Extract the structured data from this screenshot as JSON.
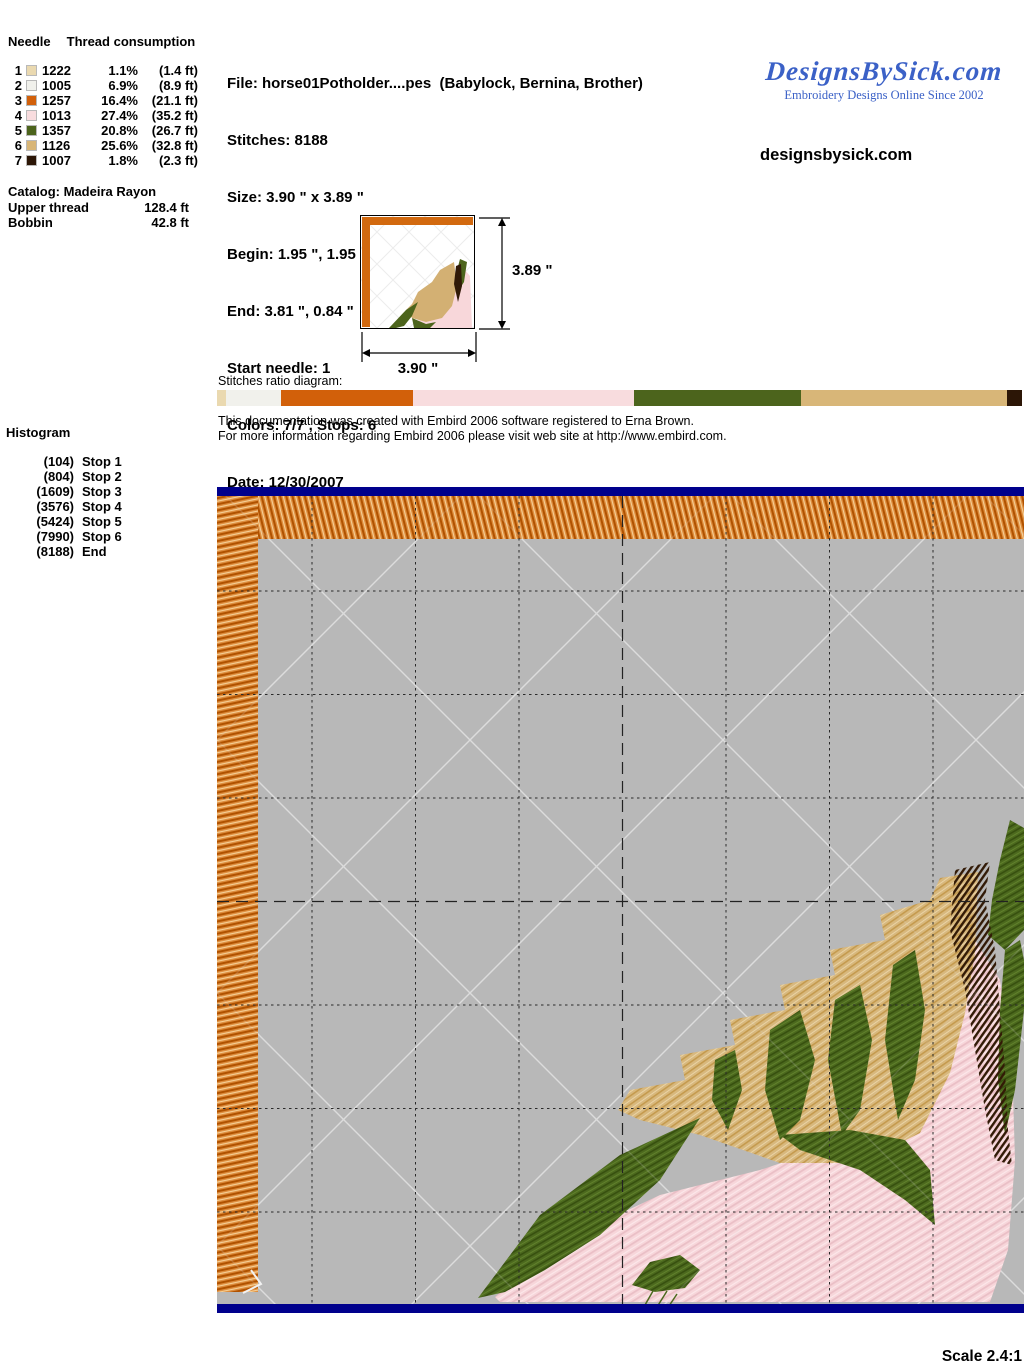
{
  "palette": {
    "hoop_bar_blue": "#00008c",
    "canvas_gray": "#b8b8b8",
    "border_stitch_orange": "#dc8a3a",
    "logo_blue": "#3b61c7",
    "grid_line": "#2a2a2a",
    "quilt_line": "#dedede"
  },
  "needle_table": {
    "header_needle": "Needle",
    "header_consumption": "Thread consumption",
    "rows": [
      {
        "needle": "1",
        "thread": "1222",
        "pct": "1.1%",
        "pct_value": 1.1,
        "length": "(1.4 ft)",
        "color": "#ead9b0"
      },
      {
        "needle": "2",
        "thread": "1005",
        "pct": "6.9%",
        "pct_value": 6.9,
        "length": "(8.9 ft)",
        "color": "#f1f1ec"
      },
      {
        "needle": "3",
        "thread": "1257",
        "pct": "16.4%",
        "pct_value": 16.4,
        "length": "(21.1 ft)",
        "color": "#d2600a"
      },
      {
        "needle": "4",
        "thread": "1013",
        "pct": "27.4%",
        "pct_value": 27.4,
        "length": "(35.2 ft)",
        "color": "#f8dcde"
      },
      {
        "needle": "5",
        "thread": "1357",
        "pct": "20.8%",
        "pct_value": 20.8,
        "length": "(26.7 ft)",
        "color": "#4c641c"
      },
      {
        "needle": "6",
        "thread": "1126",
        "pct": "25.6%",
        "pct_value": 25.6,
        "length": "(32.8 ft)",
        "color": "#d8b678"
      },
      {
        "needle": "7",
        "thread": "1007",
        "pct": "1.8%",
        "pct_value": 1.8,
        "length": "(2.3 ft)",
        "color": "#2c1606"
      }
    ]
  },
  "catalog": {
    "label": "Catalog: Madeira Rayon",
    "upper_label": "Upper thread",
    "upper_value": "128.4 ft",
    "bobbin_label": "Bobbin",
    "bobbin_value": "42.8 ft"
  },
  "file_info": {
    "lines": [
      "File: horse01Potholder....pes  (Babylock, Bernina, Brother)",
      "Stitches: 8188",
      "Size: 3.90 \" x 3.89 \"",
      "Begin: 1.95 \", 1.95 \"",
      "End: 3.81 \", 0.84 \"",
      "Start needle: 1",
      "Colors: 7/7 , Stops: 6",
      "Date: 12/30/2007"
    ]
  },
  "branding": {
    "logo_text": "DesignsBySick.com",
    "tagline": "Embroidery Designs Online Since 2002",
    "website": "designsbysick.com"
  },
  "preview": {
    "width_label": "3.90 \"",
    "height_label": "3.89 \""
  },
  "ratio": {
    "label": "Stitches ratio diagram:"
  },
  "doc_note": {
    "line1": "This documentation was created with Embird 2006 software registered to Erna Brown.",
    "line2": "For more information regarding Embird 2006 please visit web site at http://www.embird.com."
  },
  "histogram": {
    "title": "Histogram",
    "entries": [
      {
        "count": "(104)",
        "label": "Stop 1"
      },
      {
        "count": "(804)",
        "label": "Stop 2"
      },
      {
        "count": "(1609)",
        "label": "Stop 3"
      },
      {
        "count": "(3576)",
        "label": "Stop 4"
      },
      {
        "count": "(5424)",
        "label": "Stop 5"
      },
      {
        "count": "(7990)",
        "label": "Stop 6"
      },
      {
        "count": "(8188)",
        "label": "End"
      }
    ]
  },
  "scale_label": "Scale 2.4:1"
}
